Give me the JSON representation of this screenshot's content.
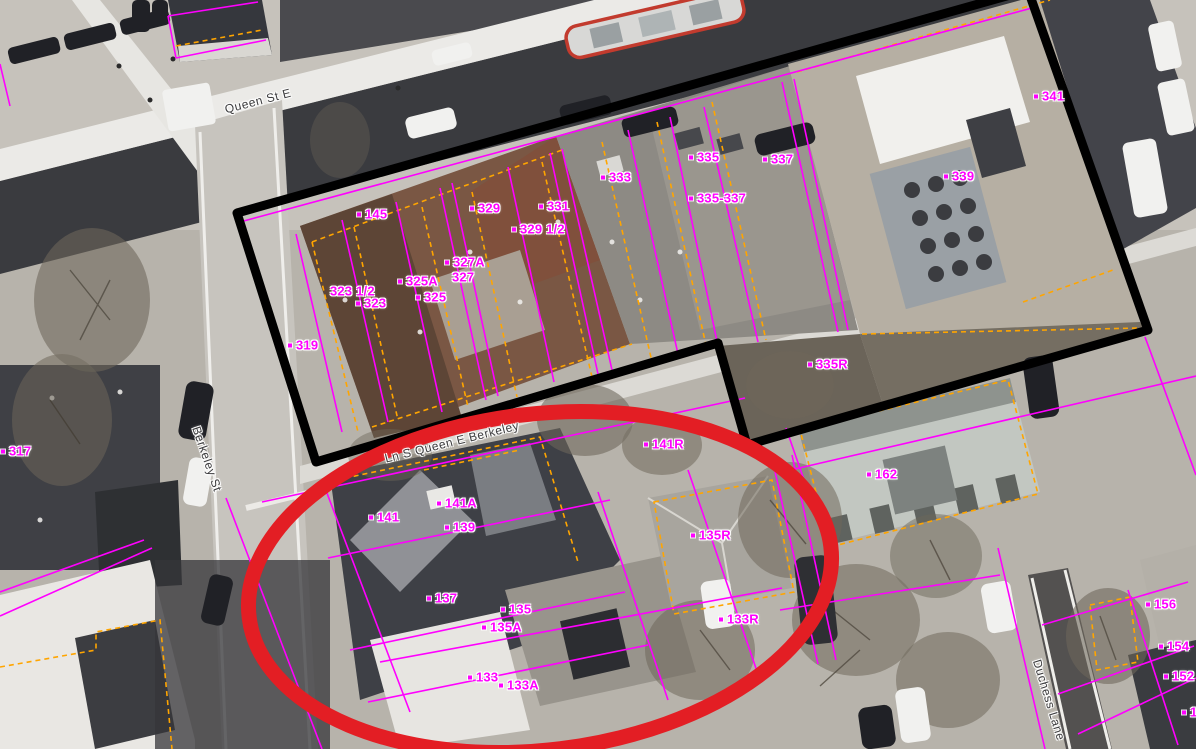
{
  "map": {
    "description": "Aerial orthophoto parcel map with property boundary overlays",
    "streets": [
      {
        "id": "queen-st-e",
        "text": "Queen St E",
        "x": 258,
        "y": 101,
        "rotation": -14.5
      },
      {
        "id": "berkeley-st",
        "text": "Berkeley St",
        "x": 207,
        "y": 459,
        "rotation": 71
      },
      {
        "id": "ln-s-queen-e-berkeley",
        "text": "Ln S Queen E Berkeley",
        "x": 452,
        "y": 442,
        "rotation": -14
      },
      {
        "id": "duchess-lane",
        "text": "Duchess Lane",
        "x": 1049,
        "y": 700,
        "rotation": 73
      }
    ],
    "addresses": [
      {
        "text": "145",
        "x": 357,
        "y": 214,
        "dot": true
      },
      {
        "text": "319",
        "x": 288,
        "y": 345,
        "dot": true
      },
      {
        "text": "317",
        "x": 1,
        "y": 451,
        "dot": true
      },
      {
        "text": "323 1/2",
        "x": 330,
        "y": 291,
        "dot": false
      },
      {
        "text": "323",
        "x": 356,
        "y": 303,
        "dot": true
      },
      {
        "text": "325A",
        "x": 398,
        "y": 281,
        "dot": true
      },
      {
        "text": "325",
        "x": 416,
        "y": 297,
        "dot": true
      },
      {
        "text": "327A",
        "x": 445,
        "y": 262,
        "dot": true
      },
      {
        "text": "327",
        "x": 452,
        "y": 277,
        "dot": false
      },
      {
        "text": "329",
        "x": 470,
        "y": 208,
        "dot": true
      },
      {
        "text": "329 1/2",
        "x": 512,
        "y": 229,
        "dot": true
      },
      {
        "text": "331",
        "x": 539,
        "y": 206,
        "dot": true
      },
      {
        "text": "333",
        "x": 601,
        "y": 177,
        "dot": true
      },
      {
        "text": "335",
        "x": 689,
        "y": 157,
        "dot": true
      },
      {
        "text": "335-337",
        "x": 689,
        "y": 198,
        "dot": true
      },
      {
        "text": "337",
        "x": 763,
        "y": 159,
        "dot": true
      },
      {
        "text": "339",
        "x": 944,
        "y": 176,
        "dot": true
      },
      {
        "text": "341",
        "x": 1034,
        "y": 96,
        "dot": true
      },
      {
        "text": "335R",
        "x": 808,
        "y": 364,
        "dot": true
      },
      {
        "text": "141R",
        "x": 644,
        "y": 444,
        "dot": true
      },
      {
        "text": "162",
        "x": 867,
        "y": 474,
        "dot": true
      },
      {
        "text": "141A",
        "x": 437,
        "y": 503,
        "dot": true
      },
      {
        "text": "141",
        "x": 369,
        "y": 517,
        "dot": true
      },
      {
        "text": "139",
        "x": 445,
        "y": 527,
        "dot": true
      },
      {
        "text": "137",
        "x": 427,
        "y": 598,
        "dot": true
      },
      {
        "text": "135",
        "x": 501,
        "y": 609,
        "dot": true
      },
      {
        "text": "135A",
        "x": 482,
        "y": 627,
        "dot": true
      },
      {
        "text": "135R",
        "x": 691,
        "y": 535,
        "dot": true
      },
      {
        "text": "133",
        "x": 468,
        "y": 677,
        "dot": true
      },
      {
        "text": "133A",
        "x": 499,
        "y": 685,
        "dot": true
      },
      {
        "text": "133R",
        "x": 719,
        "y": 619,
        "dot": true
      },
      {
        "text": "156",
        "x": 1146,
        "y": 604,
        "dot": true
      },
      {
        "text": "154",
        "x": 1159,
        "y": 646,
        "dot": true
      },
      {
        "text": "152",
        "x": 1164,
        "y": 676,
        "dot": true
      },
      {
        "text": "1",
        "x": 1182,
        "y": 712,
        "dot": true
      }
    ],
    "annotations": {
      "boundary_polygon": {
        "color": "#000000",
        "stroke_width": 9,
        "points": [
          [
            237,
            213
          ],
          [
            1028,
            -10
          ],
          [
            1148,
            330
          ],
          [
            747,
            445
          ],
          [
            718,
            343
          ],
          [
            316,
            462
          ]
        ]
      },
      "highlight_ellipse": {
        "color": "#e31e24",
        "stroke_width": 15,
        "cx": 540,
        "cy": 582,
        "rx": 293,
        "ry": 168,
        "rotation": -7
      }
    },
    "overlay_colors": {
      "parcel_line": "#ff00ff",
      "building_outline": "#ffa500",
      "address_label": "#ff00ff",
      "street_label": "#3c3c3e"
    }
  }
}
